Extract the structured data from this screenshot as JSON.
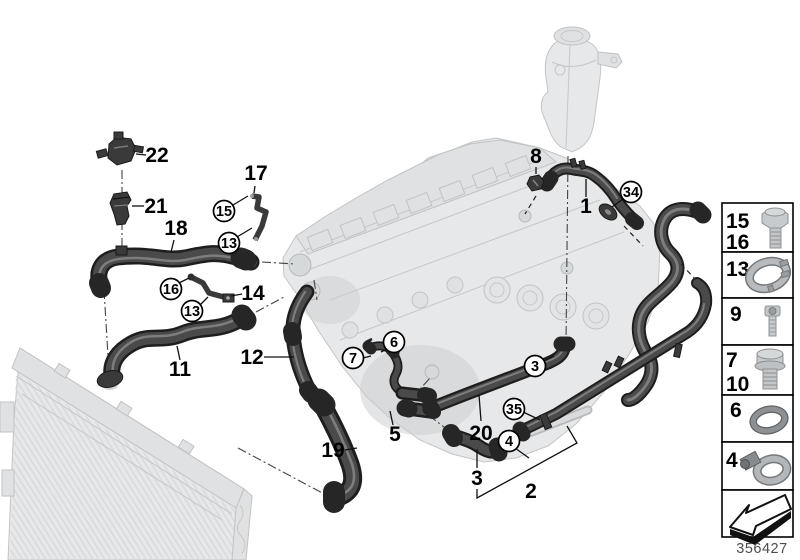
{
  "diagram": {
    "number": "356427",
    "background": "#ffffff"
  },
  "colors": {
    "part_dark": "#3a3a3a",
    "hose_body": "#4a4a4a",
    "ghost_fill": "#e6e8e9",
    "outline": "#1e1e1e"
  },
  "callouts": {
    "k1": "1",
    "k2": "2",
    "k3": "3",
    "k3c": "3",
    "k4": "4",
    "k5": "5",
    "k6": "6",
    "k7": "7",
    "k8": "8",
    "k11": "11",
    "k12": "12",
    "k13a": "13",
    "k13b": "13",
    "k14": "14",
    "k15": "15",
    "k16": "16",
    "k17": "17",
    "k18": "18",
    "k19": "19",
    "k20": "20",
    "k21": "21",
    "k22": "22",
    "k34": "34",
    "k35": "35"
  },
  "legend": {
    "rows": [
      {
        "labels": [
          "15",
          "16"
        ],
        "icon": "hex-bolt"
      },
      {
        "labels": [
          "13"
        ],
        "icon": "hose-clamp-ring"
      },
      {
        "labels": [
          "9"
        ],
        "icon": "socket-head-screw"
      },
      {
        "labels": [
          "7",
          "10"
        ],
        "icon": "hex-flange-bolt"
      },
      {
        "labels": [
          "6"
        ],
        "icon": "o-ring"
      },
      {
        "labels": [
          "4"
        ],
        "icon": "worm-drive-clamp"
      },
      {
        "labels": [],
        "icon": "direction-arrow"
      }
    ]
  }
}
